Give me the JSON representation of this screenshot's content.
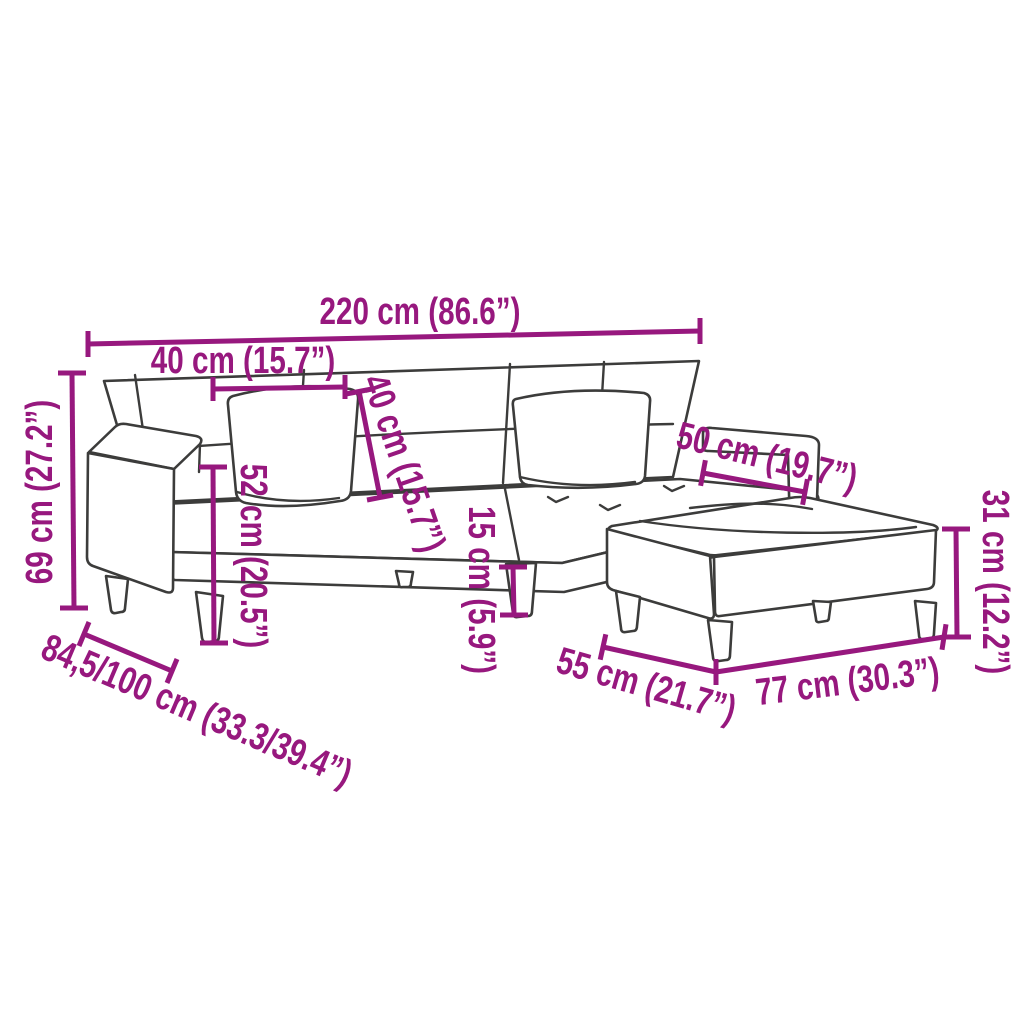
{
  "diagram": {
    "subject": "Sofa bed with two back cushions and footstool — technical dimension drawing",
    "colors": {
      "accent": "#97187E",
      "line_art": "#3C3C3B",
      "background": "#FFFFFF"
    },
    "units": [
      "cm",
      "inches"
    ],
    "dimensions": [
      {
        "id": "overall-width",
        "value_cm": "220",
        "label": "220 cm (86.6”)"
      },
      {
        "id": "back-cushion-width",
        "value_cm": "40",
        "label": "40 cm (15.7”)"
      },
      {
        "id": "back-cushion-height",
        "value_cm": "40",
        "label": "40 cm (15.7”)"
      },
      {
        "id": "overall-height",
        "value_cm": "69",
        "label": "69 cm (27.2”)"
      },
      {
        "id": "armrest-height",
        "value_cm": "52",
        "label": "52 cm (20.5”)"
      },
      {
        "id": "leg-height",
        "value_cm": "15",
        "label": "15 cm (5.9”)"
      },
      {
        "id": "armrest-length",
        "value_cm": "50",
        "label": "50 cm (19.7”)"
      },
      {
        "id": "footstool-height",
        "value_cm": "31",
        "label": "31 cm (12.2”)"
      },
      {
        "id": "footstool-depth",
        "value_cm": "55",
        "label": "55 cm (21.7”)"
      },
      {
        "id": "footstool-width",
        "value_cm": "77",
        "label": "77 cm (30.3”)"
      },
      {
        "id": "depth-min-max",
        "value_cm": "84,5/100",
        "label": "84,5/100 cm (33.3/39.4”)"
      }
    ]
  }
}
